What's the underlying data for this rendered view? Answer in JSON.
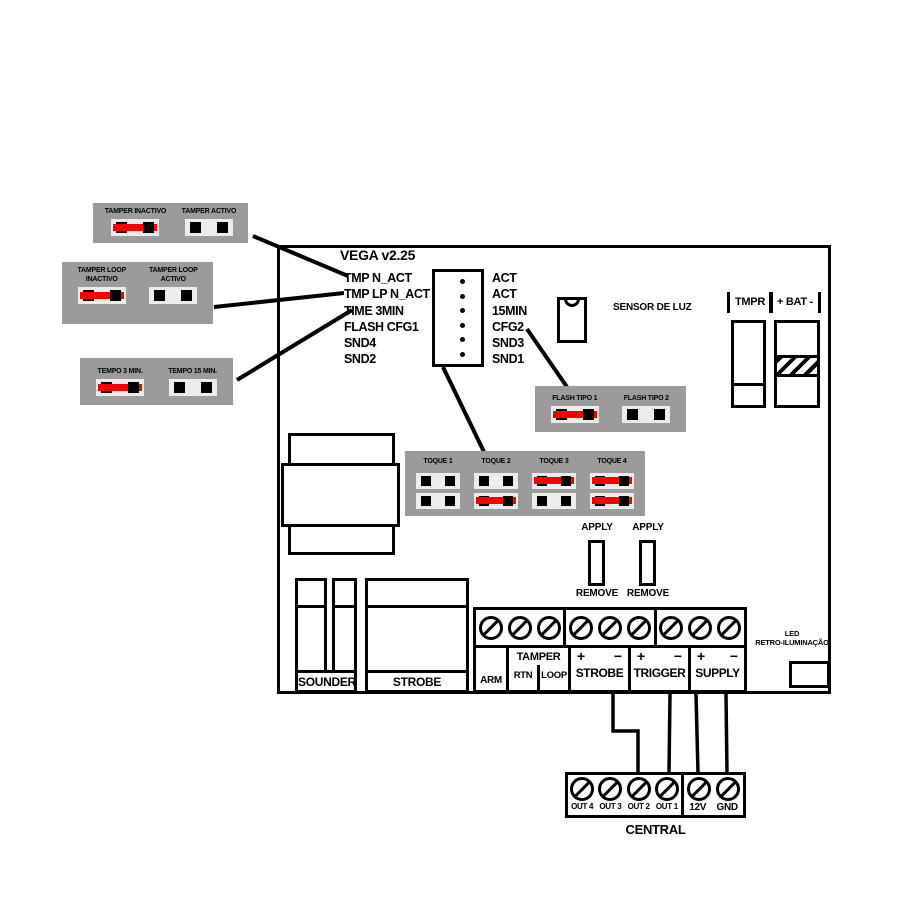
{
  "title": "VEGA v2.25",
  "legend": {
    "tamper": [
      {
        "label": "TAMPER INACTIVO",
        "state": "closed"
      },
      {
        "label": "TAMPER ACTIVO",
        "state": "open"
      }
    ],
    "tamper_loop": [
      {
        "label": "TAMPER LOOP INACTIVO",
        "state": "closed"
      },
      {
        "label": "TAMPER LOOP ACTIVO",
        "state": "open"
      }
    ],
    "tempo": [
      {
        "label": "TEMPO 3 MIN.",
        "state": "closed"
      },
      {
        "label": "TEMPO 15 MIN.",
        "state": "open"
      }
    ],
    "flash": [
      {
        "label": "FLASH TIPO 1",
        "state": "closed"
      },
      {
        "label": "FLASH TIPO 2",
        "state": "open"
      }
    ],
    "toque": [
      {
        "label": "TOQUE 1",
        "top": "open",
        "bottom": "open"
      },
      {
        "label": "TOQUE 2",
        "top": "open",
        "bottom": "closed"
      },
      {
        "label": "TOQUE 3",
        "top": "closed",
        "bottom": "open"
      },
      {
        "label": "TOQUE 4",
        "top": "closed",
        "bottom": "closed"
      }
    ]
  },
  "header_pins": {
    "left": [
      "TMP N_ACT",
      "TMP LP N_ACT",
      "TIME 3MIN",
      "FLASH CFG1",
      "SND4",
      "SND2"
    ],
    "right": [
      "ACT",
      "ACT",
      "15MIN",
      "CFG2",
      "SND3",
      "SND1"
    ]
  },
  "sensor_label": "SENSOR DE LUZ",
  "top_right": {
    "tmpr": "TMPR",
    "bat": "+ BAT -"
  },
  "apply_remove": {
    "apply": "APPLY",
    "remove": "REMOVE"
  },
  "output_blocks": {
    "sounder": "SOUNDER",
    "strobe": "STROBE"
  },
  "terminal_strip": {
    "arm": "ARM",
    "tamper": {
      "title": "TAMPER",
      "left": "RTN",
      "right": "LOOP"
    },
    "strobe": {
      "plus": "+",
      "minus": "−",
      "title": "STROBE"
    },
    "trigger": {
      "plus": "+",
      "minus": "−",
      "title": "TRIGGER"
    },
    "supply": {
      "plus": "+",
      "minus": "−",
      "title": "SUPPLY"
    }
  },
  "led_label": {
    "line1": "LED",
    "line2": "RETRO-ILUMINAÇÃO"
  },
  "central": {
    "outputs": [
      "OUT 4",
      "OUT 3",
      "OUT 2",
      "OUT 1"
    ],
    "power": [
      "12V",
      "GND"
    ],
    "label": "CENTRAL"
  },
  "colors": {
    "panel_gray": "#9b9b9b",
    "window_gray": "#ececec",
    "jumper_red": "#f60000"
  }
}
